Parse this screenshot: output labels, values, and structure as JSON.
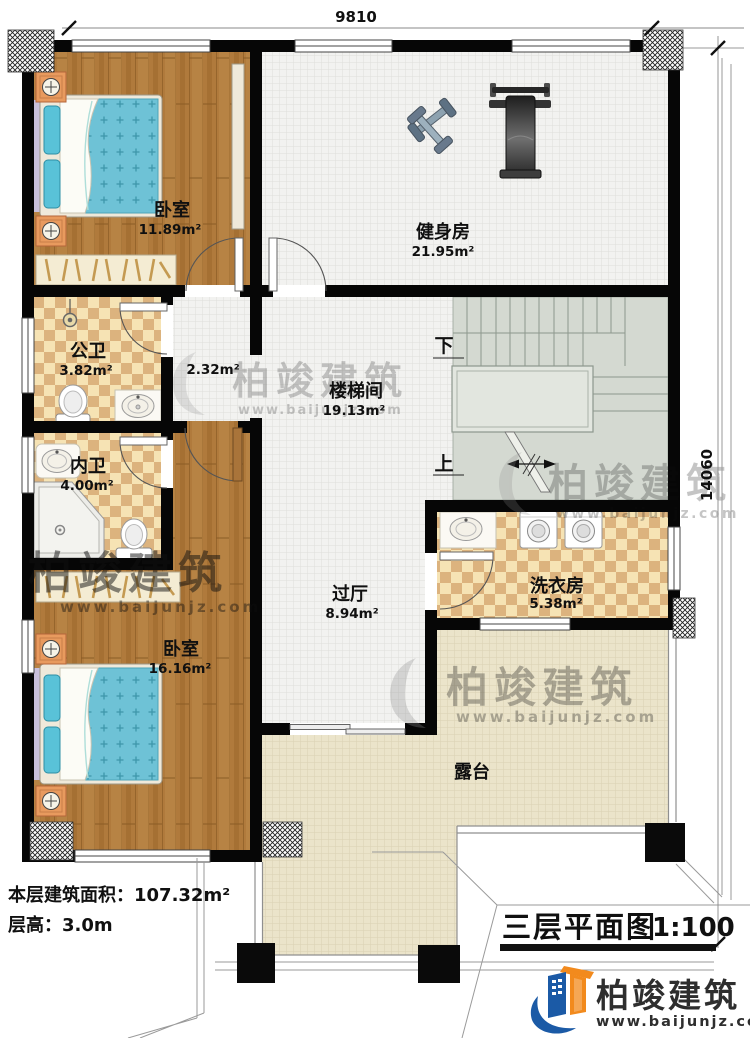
{
  "plan": {
    "dimensions": {
      "top": "9810",
      "right": "14060"
    },
    "rooms": {
      "bedroom1": {
        "name": "卧室",
        "area": "11.89m²"
      },
      "gym": {
        "name": "健身房",
        "area": "21.95m²"
      },
      "public_bath": {
        "name": "公卫",
        "area": "3.82m²"
      },
      "corridor": {
        "area": "2.32m²"
      },
      "stairwell": {
        "name": "楼梯间",
        "area": "19.13m²"
      },
      "private_bath": {
        "name": "内卫",
        "area": "4.00m²"
      },
      "laundry": {
        "name": "洗衣房",
        "area": "5.38m²"
      },
      "hall": {
        "name": "过厅",
        "area": "8.94m²"
      },
      "bedroom2": {
        "name": "卧室",
        "area": "16.16m²"
      },
      "terrace": {
        "name": "露台"
      }
    },
    "stairs": {
      "up": "上",
      "down": "下"
    },
    "info": {
      "area_line": "本层建筑面积：107.32m²",
      "height_line": "层高：3.0m"
    },
    "titleblock": {
      "title": "三层平面图",
      "scale": "1:100"
    },
    "brand": {
      "name": "柏竣建筑",
      "url": "www.baijunjz.com"
    },
    "watermark": {
      "name": "柏竣建筑",
      "url": "www.baijunjz.com"
    }
  }
}
